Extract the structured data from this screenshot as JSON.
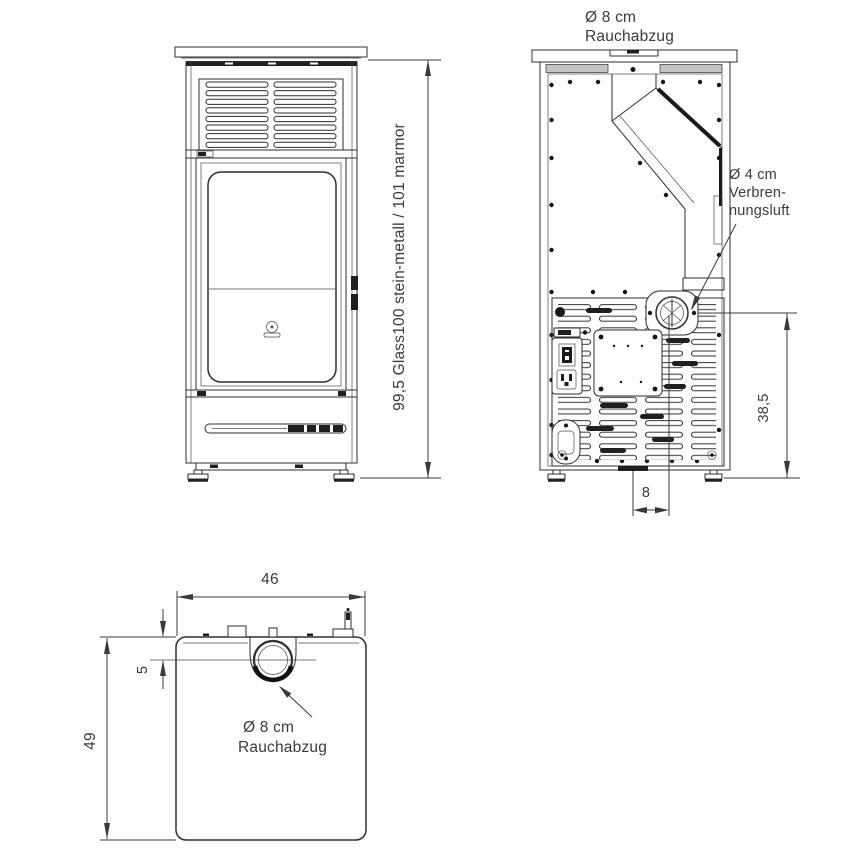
{
  "diagram": {
    "front_view": {
      "height_label": "99,5 Glass100 stein-metall / 101 marmor"
    },
    "rear_view": {
      "flue_label": {
        "line1": "Ø 8 cm",
        "line2": "Rauchabzug"
      },
      "combustion_air_label": {
        "line1": "Ø 4 cm",
        "line2": "Verbren-",
        "line3": "nungsluft"
      },
      "flue_height_dim": "38,5",
      "flue_offset_dim": "8"
    },
    "top_view": {
      "width_dim": "46",
      "depth_dim": "49",
      "flue_inset_dim": "5",
      "flue_label": {
        "line1": "Ø 8 cm",
        "line2": "Rauchabzug"
      }
    },
    "colors": {
      "line": "#2e2e2e",
      "text": "#3a3a3a",
      "background": "#ffffff"
    }
  }
}
